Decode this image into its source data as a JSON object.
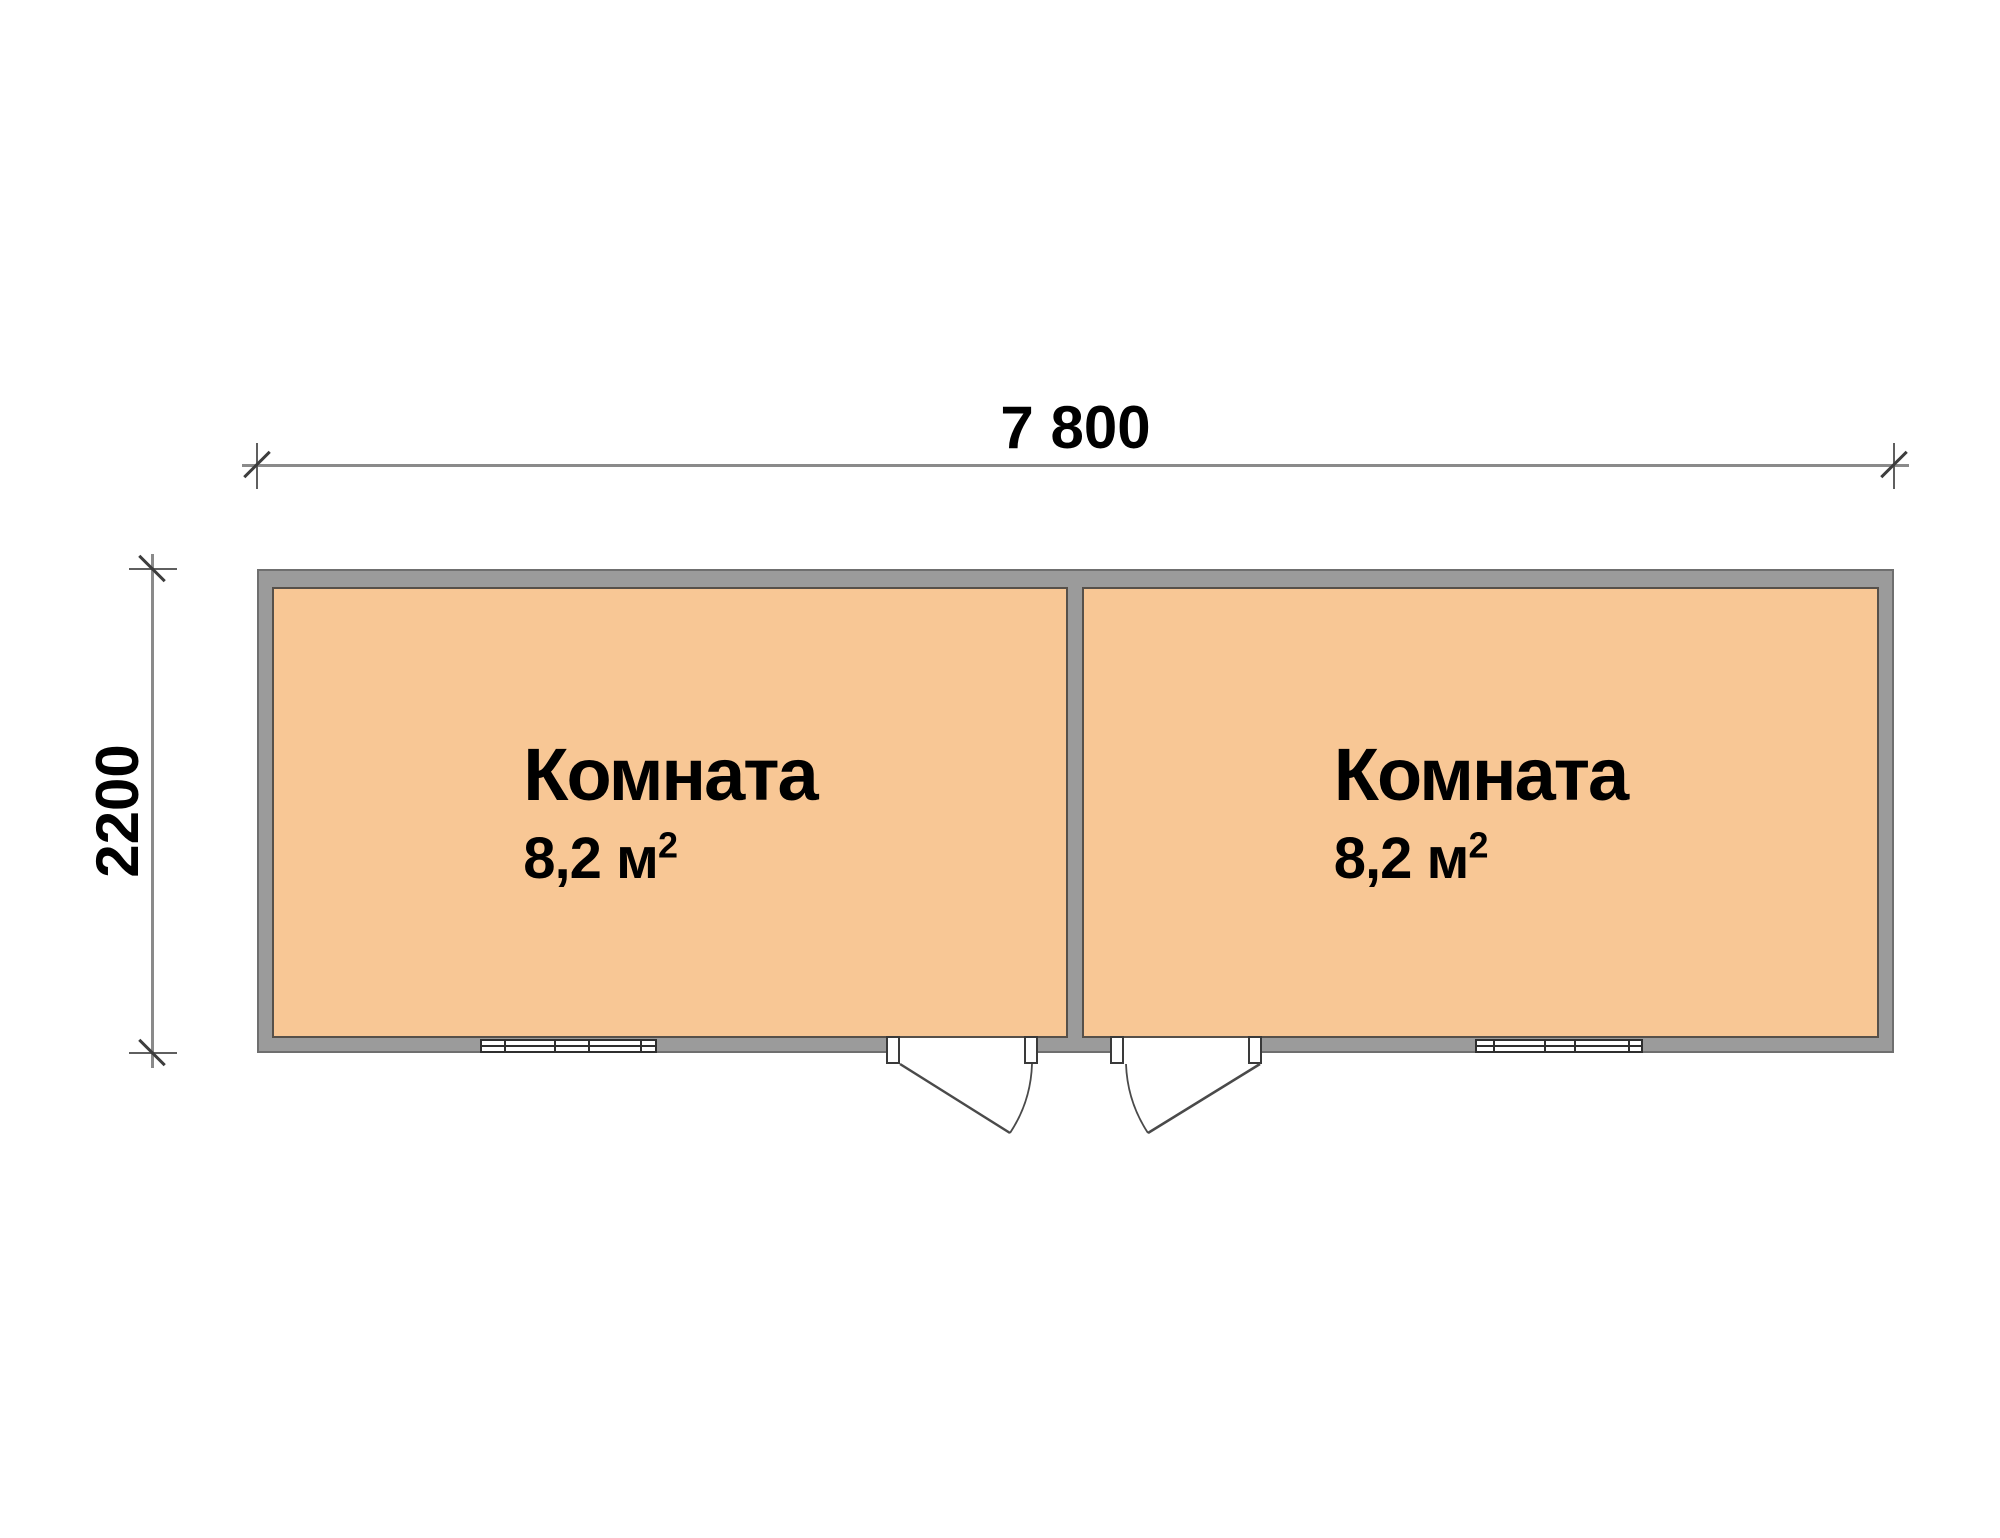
{
  "dimensions": {
    "width_label": "7 800",
    "depth_label": "2200"
  },
  "rooms": [
    {
      "name": "Комната",
      "area_base": "8,2 м",
      "area_exponent": "2"
    },
    {
      "name": "Комната",
      "area_base": "8,2 м",
      "area_exponent": "2"
    }
  ],
  "colors": {
    "background": "#ffffff",
    "room_fill": "#f8c795",
    "wall_fill": "#9b9b9b",
    "wall_outline": "#6f6f6f",
    "room_outline": "#56504a",
    "dimension_line": "#8a8a8a",
    "tick_mark": "#3d3d3d",
    "door_line": "#4a4a4a",
    "text": "#000000"
  }
}
